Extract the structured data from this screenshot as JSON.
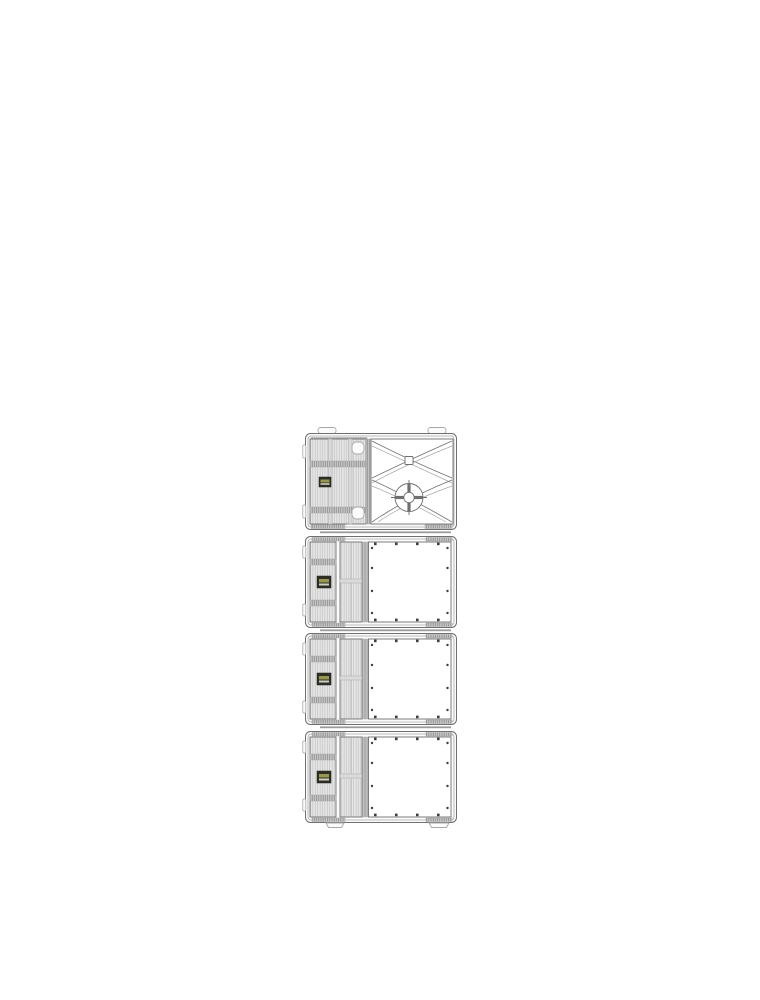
{
  "canvas": {
    "background": "#ffffff"
  },
  "drawing": {
    "type": "technical-line-drawing",
    "subject": "vertical stack of four loudspeaker cabinets, front view",
    "units": [
      {
        "name": "cabinet-unit-1",
        "front": "grille-and-horn",
        "features": [
          "top-rigging-tabs",
          "badge",
          "handle-cups",
          "horn-flare",
          "compression-driver"
        ]
      },
      {
        "name": "cabinet-unit-2",
        "front": "grille-and-blank-panel",
        "features": [
          "badge",
          "screwed-panel"
        ]
      },
      {
        "name": "cabinet-unit-3",
        "front": "grille-and-blank-panel",
        "features": [
          "badge",
          "screwed-panel"
        ]
      },
      {
        "name": "cabinet-unit-4",
        "front": "grille-and-blank-panel",
        "features": [
          "badge",
          "screwed-panel",
          "feet"
        ]
      }
    ],
    "panel_screws_per_side": 4,
    "gap_rails_between_units": 3
  },
  "colors": {
    "page_bg": "#ffffff",
    "line": "#6f6f6f",
    "line_light": "#a8a8a8",
    "case_fill": "#fbfbfb",
    "grille_fill": "#e6e6e6",
    "grille_line": "#bcbcbc",
    "hatch_fill": "#c9c9c9",
    "hatch_line": "#7f7f7f",
    "panel_fill": "#ffffff",
    "screw": "#3f3f3f",
    "badge_dark": "#2f2f26",
    "badge_accent": "#97974e",
    "badge_light": "#cfcfc2",
    "rail": "#9b9b9b"
  }
}
